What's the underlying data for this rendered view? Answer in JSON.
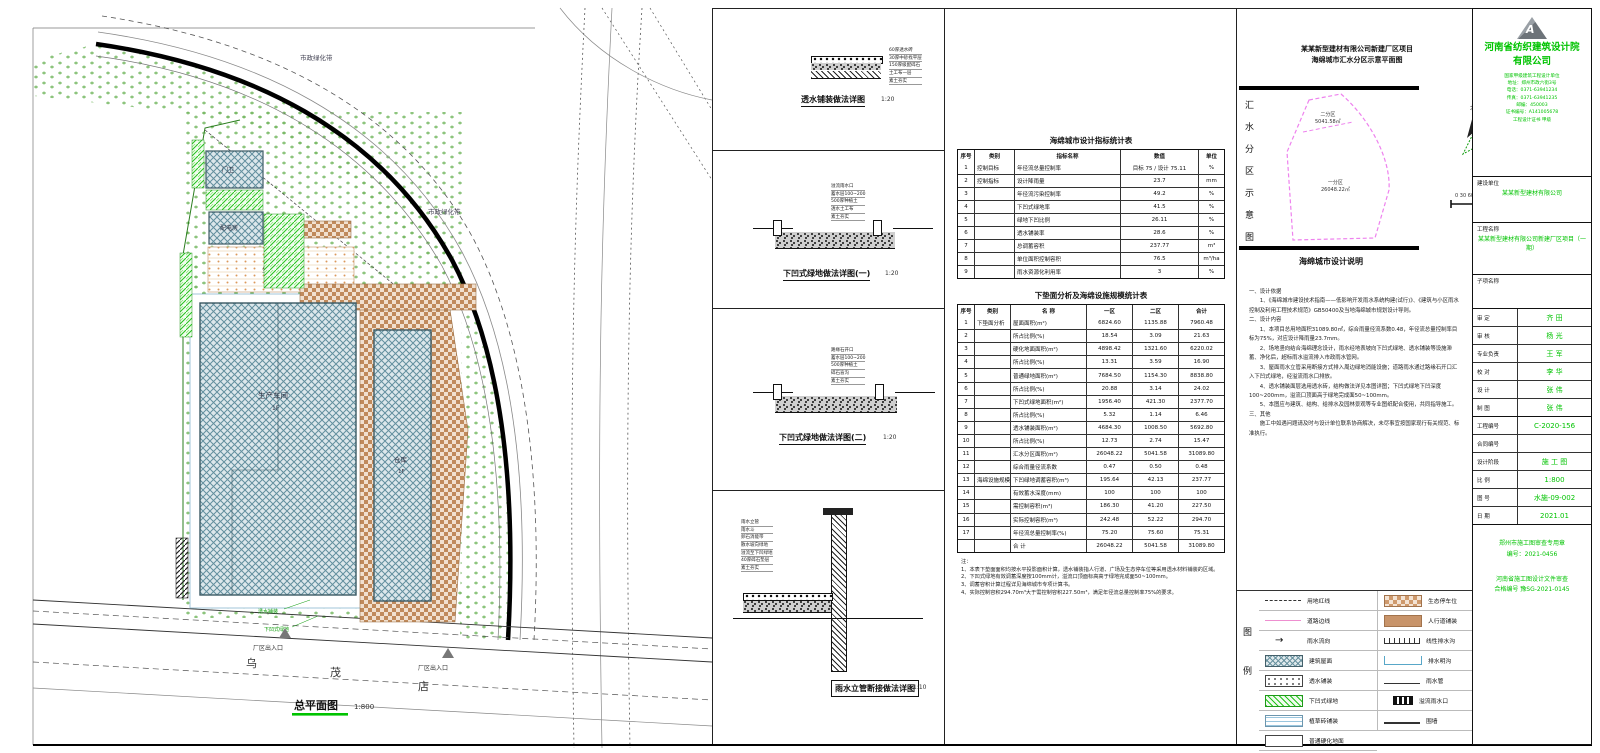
{
  "site": {
    "caption": "总平面图",
    "scale": "1:800",
    "greenbelt1": "市政绿化带",
    "greenbelt2": "市政绿化带",
    "bldg_gate": "门卫",
    "bldg_power": "配电房",
    "bldg_main": "生产车间",
    "bldg_main_floor": "1F",
    "bldg_ware": "仓库",
    "bldg_ware_floor": "1F",
    "parking_label": "生态停车场",
    "label_perv": "透水铺装",
    "label_sunken": "下凹式绿地",
    "entrance1": "厂区出入口",
    "entrance2": "厂区出入口",
    "road_chars": [
      "乌",
      "茂",
      "店"
    ]
  },
  "details": [
    {
      "caption": "透水铺装做法详图",
      "scale": "1:20",
      "notes": [
        "60厚透水砖",
        "30厚中砂找平层",
        "150厚级配碎石",
        "土工布一层",
        "素土夯实"
      ]
    },
    {
      "caption": "下凹式绿地做法详图(一)",
      "scale": "1:20",
      "notes": [
        "溢流雨水口",
        "蓄水层100~200",
        "500厚种植土",
        "透水土工布",
        "素土夯实"
      ]
    },
    {
      "caption": "下凹式绿地做法详图(二)",
      "scale": "1:20",
      "notes": [
        "路缘石开口",
        "蓄水层100~200",
        "500厚种植土",
        "碎石盲沟",
        "素土夯实"
      ]
    },
    {
      "caption": "雨水立管断接做法详图",
      "scale": "1:10",
      "notes": [
        "雨水立管",
        "雨水斗",
        "卵石消能带",
        "散水坡向绿地",
        "溢流至下凹绿地",
        "40厚碎石垫层",
        "素土夯实"
      ]
    }
  ],
  "stats": {
    "table1": {
      "title": "海绵城市设计指标统计表",
      "headers": [
        "序号",
        "类别",
        "指标名称",
        "数值",
        "单位"
      ],
      "rows": [
        {
          "n": "1",
          "g": "控制目标",
          "name": "年径流总量控制率",
          "v": "目标 75 / 设计 75.11",
          "u": "%"
        },
        {
          "n": "2",
          "g": "控制指标",
          "name": "设计降雨量",
          "v": "23.7",
          "u": "mm"
        },
        {
          "n": "3",
          "g": "",
          "name": "年径流污染控制率",
          "v": "49.2",
          "u": "%"
        },
        {
          "n": "4",
          "g": "",
          "name": "下凹式绿地率",
          "v": "41.5",
          "u": "%"
        },
        {
          "n": "5",
          "g": "",
          "name": "绿地下凹比例",
          "v": "26.11",
          "u": "%"
        },
        {
          "n": "6",
          "g": "",
          "name": "透水铺装率",
          "v": "28.6",
          "u": "%"
        },
        {
          "n": "7",
          "g": "",
          "name": "总调蓄容积",
          "v": "237.77",
          "u": "m³"
        },
        {
          "n": "8",
          "g": "",
          "name": "单位面积控制容积",
          "v": "76.5",
          "u": "m³/ha"
        },
        {
          "n": "9",
          "g": "",
          "name": "雨水资源化利用率",
          "v": "3",
          "u": "%"
        }
      ]
    },
    "table2": {
      "title": "下垫面分析及海绵设施规模统计表",
      "headers": [
        "序号",
        "类别",
        "名  称",
        "一区",
        "二区",
        "合计"
      ],
      "rows": [
        {
          "n": "1",
          "g": "下垫面分析",
          "name": "屋面面积(m²)",
          "v1": "6824.60",
          "v2": "1135.88",
          "v3": "7960.48"
        },
        {
          "n": "2",
          "g": "",
          "name": "所占比例(%)",
          "v1": "18.54",
          "v2": "3.09",
          "v3": "21.63"
        },
        {
          "n": "3",
          "g": "",
          "name": "硬化地面面积(m²)",
          "v1": "4898.42",
          "v2": "1321.60",
          "v3": "6220.02"
        },
        {
          "n": "4",
          "g": "",
          "name": "所占比例(%)",
          "v1": "13.31",
          "v2": "3.59",
          "v3": "16.90"
        },
        {
          "n": "5",
          "g": "",
          "name": "普通绿地面积(m²)",
          "v1": "7684.50",
          "v2": "1154.30",
          "v3": "8838.80"
        },
        {
          "n": "6",
          "g": "",
          "name": "所占比例(%)",
          "v1": "20.88",
          "v2": "3.14",
          "v3": "24.02"
        },
        {
          "n": "7",
          "g": "",
          "name": "下凹式绿地面积(m²)",
          "v1": "1956.40",
          "v2": "421.30",
          "v3": "2377.70"
        },
        {
          "n": "8",
          "g": "",
          "name": "所占比例(%)",
          "v1": "5.32",
          "v2": "1.14",
          "v3": "6.46"
        },
        {
          "n": "9",
          "g": "",
          "name": "透水铺装面积(m²)",
          "v1": "4684.30",
          "v2": "1008.50",
          "v3": "5692.80"
        },
        {
          "n": "10",
          "g": "",
          "name": "所占比例(%)",
          "v1": "12.73",
          "v2": "2.74",
          "v3": "15.47"
        },
        {
          "n": "11",
          "g": "",
          "name": "汇水分区面积(m²)",
          "v1": "26048.22",
          "v2": "5041.58",
          "v3": "31089.80"
        },
        {
          "n": "12",
          "g": "",
          "name": "综合雨量径流系数",
          "v1": "0.47",
          "v2": "0.50",
          "v3": "0.48"
        },
        {
          "n": "13",
          "g": "海绵设施规模",
          "name": "下凹绿地调蓄容积(m³)",
          "v1": "195.64",
          "v2": "42.13",
          "v3": "237.77"
        },
        {
          "n": "14",
          "g": "",
          "name": "有效蓄水深度(mm)",
          "v1": "100",
          "v2": "100",
          "v3": "100"
        },
        {
          "n": "15",
          "g": "",
          "name": "需控制容积(m³)",
          "v1": "186.30",
          "v2": "41.20",
          "v3": "227.50"
        },
        {
          "n": "16",
          "g": "",
          "name": "实际控制容积(m³)",
          "v1": "242.48",
          "v2": "52.22",
          "v3": "294.70"
        },
        {
          "n": "17",
          "g": "",
          "name": "年径流总量控制率(%)",
          "v1": "75.20",
          "v2": "75.60",
          "v3": "75.31"
        },
        {
          "n": "",
          "g": "",
          "name": "合  计",
          "v1": "26048.22",
          "v2": "5041.58",
          "v3": "31089.80"
        }
      ]
    },
    "notes_title": "注：",
    "notes": [
      "1、本表下垫面面积均按水平投影面积计算，透水铺装指人行道、广场及生态停车位等采用透水材料铺装的区域。",
      "2、下凹式绿地有效调蓄深度按100mm计，溢流口顶面标高高于绿地完成面50~100mm。",
      "3、调蓄容积计算过程详见海绵城市专项计算书。",
      "4、实际控制容积294.70m³大于需控制容积227.50m³，满足年径流总量控制率75%的要求。"
    ]
  },
  "map": {
    "title1": "某某新型建材有限公司新建厂区项目",
    "title2": "海绵城市汇水分区示意平面图",
    "vchars": [
      "汇",
      "水",
      "分",
      "区",
      "示",
      "意",
      "图"
    ],
    "zone2": "二分区",
    "zone2_area": "5041.58㎡",
    "zone1": "一分区",
    "zone1_area": "26048.22㎡",
    "caption": "海绵城市设计说明",
    "north": "北",
    "scale_text": "0   30   60m"
  },
  "design_notes": {
    "lines": [
      "一、设计依据",
      "　　1、《海绵城市建设技术指南——低影响开发雨水系统构建(试行)》、《建筑与小区雨水控制及利用工程技术规范》GB50400及当地海绵城市规划设计导则。",
      "二、设计内容",
      "　　1、本项目总用地面积31089.80㎡，综合雨量径流系数0.48，年径流总量控制率目标为75%，对应设计降雨量23.7mm。",
      "　　2、场地竖向结合海绵理念设计，雨水经地表坡向下凹式绿地、透水铺装等设施滞蓄、净化后，超标雨水溢流排入市政雨水管网。",
      "　　3、屋面雨水立管采用断接方式排入周边绿地消能设施；道路雨水通过路缘石开口汇入下凹式绿地，经溢流雨水口排放。",
      "　　4、透水铺装面层选用透水砖，结构做法详见本图详图；下凹式绿地下凹深度100~200mm，溢流口顶面高于绿地完成面50~100mm。",
      "　　5、本图应与建筑、结构、给排水及园林景观等专业图纸配合使用，共同指导施工。",
      "三、其他",
      "　　施工中如遇问题请及时与设计单位联系协商解决，未尽事宜按国家现行有关规范、标准执行。"
    ]
  },
  "legend": {
    "vchars": [
      "图",
      "例"
    ],
    "left": [
      {
        "swatch": "dashed",
        "label": "用地红线"
      },
      {
        "swatch": "pink",
        "label": "道路边线"
      },
      {
        "swatch": "arrow",
        "label": "雨水流向"
      },
      {
        "swatch": "bldg",
        "label": "建筑屋面"
      },
      {
        "swatch": "perv",
        "label": "透水铺装"
      },
      {
        "swatch": "sunken",
        "label": "下凹式绿地"
      },
      {
        "swatch": "grassbrick",
        "label": "植草砖铺装"
      },
      {
        "swatch": "plain",
        "label": "普通硬化地面"
      }
    ],
    "right": [
      {
        "swatch": "ecopark",
        "label": "生态停车位"
      },
      {
        "swatch": "sidewalk",
        "label": "人行道铺装"
      },
      {
        "swatch": "trench",
        "label": "线性排水沟"
      },
      {
        "swatch": "ditch",
        "label": "排水明沟"
      },
      {
        "swatch": "pipe",
        "label": "雨水管"
      },
      {
        "swatch": "inlet",
        "label": "溢流雨水口"
      },
      {
        "swatch": "wall",
        "label": "围墙"
      }
    ]
  },
  "titleblock": {
    "logo_letter": "A",
    "company1": "河南省纺织建筑设计院",
    "company2": "有限公司",
    "company_lines": [
      "国家甲级建筑工程设计单位",
      "地址：郑州市政六街3号",
      "电话：0371-63941234",
      "传真：0371-63941235",
      "邮编：450003",
      "证书编号：A141005678",
      "工程设计证书  甲级"
    ],
    "owner_label": "建设单位",
    "owner": "某某新型建材有限公司",
    "project_label": "工程名称",
    "project": "某某新型建材有限公司新建厂区项目（一期）",
    "subitem_label": "子项名称",
    "subitem": "",
    "sig_rows": [
      {
        "label": "审 定",
        "value": "齐 田"
      },
      {
        "label": "审 核",
        "value": "杨 光"
      },
      {
        "label": "专业负责",
        "value": "王 军"
      },
      {
        "label": "校 对",
        "value": "李 华"
      },
      {
        "label": "设 计",
        "value": "张 伟"
      },
      {
        "label": "制 图",
        "value": "张 伟"
      }
    ],
    "fields": [
      {
        "label": "工程编号",
        "value": "C-2020-156"
      },
      {
        "label": "合同编号",
        "value": ""
      },
      {
        "label": "设计阶段",
        "value": "施 工 图"
      },
      {
        "label": "比  例",
        "value": "1:800"
      },
      {
        "label": "图  号",
        "value": "水施-09-002"
      },
      {
        "label": "日  期",
        "value": "2021.01"
      }
    ],
    "stamp1": "郑州市施工图审查专用章",
    "stamp1b": "编号：2021-0456",
    "stamp2": "河南省施工图设计文件审查",
    "stamp2b": "合格编号  豫SG-2021-0145"
  }
}
